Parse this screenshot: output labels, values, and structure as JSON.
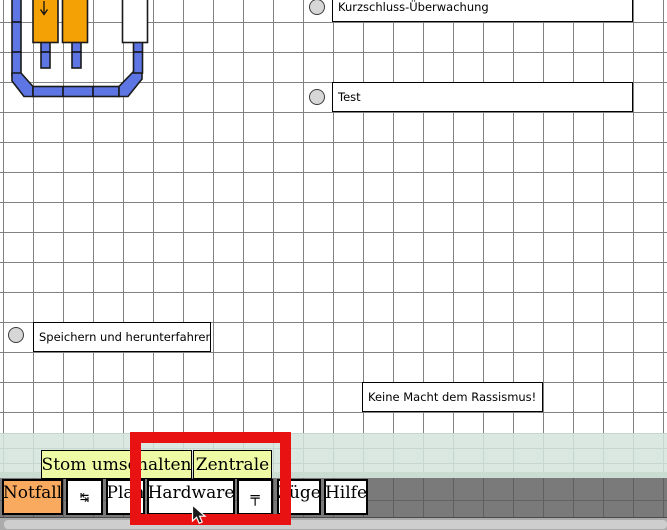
{
  "window": {
    "width": 667,
    "height": 530
  },
  "canvas": {
    "background": "#ffffff",
    "grid_color": "#828282",
    "grid_size": 30
  },
  "diagram": {
    "name": "track-layout",
    "track_color": "#5d76e3",
    "outline_color": "#1a1a1a",
    "block_occupied_color": "#f3a105",
    "block_free_color": "#ffffff",
    "blocks": [
      {
        "id": "block-1",
        "state": "occupied",
        "arrow": "↓"
      },
      {
        "id": "block-2",
        "state": "occupied"
      },
      {
        "id": "block-3",
        "state": "free"
      }
    ]
  },
  "controls": {
    "items": [
      {
        "label": "Kurzschluss-Überwachung",
        "checked": false
      },
      {
        "label": "Test",
        "checked": false
      },
      {
        "label": "Speichern und herunterfahren",
        "checked": false
      }
    ],
    "banner": "Keine Macht dem Rassismus!"
  },
  "hints": {
    "background": "#eefaa4",
    "buttons": [
      {
        "label": "Stom umschalten"
      },
      {
        "label": "Zentrale"
      }
    ]
  },
  "toolbar": {
    "background": "#7a7a7a",
    "buttons": [
      {
        "label": "Notfall",
        "background": "#f9aa5e"
      },
      {
        "label": "↹",
        "icon": "switch-direction-icon"
      },
      {
        "label": "Plan"
      },
      {
        "label": "Hardware"
      },
      {
        "label": "╤",
        "icon": "catenary-icon"
      },
      {
        "label": "Züge"
      },
      {
        "label": "Hilfe"
      }
    ]
  },
  "annotation": {
    "highlight_box_color": "#e91212"
  },
  "scrollbar": {
    "orientation": "horizontal",
    "thumb_color": "#cecece"
  }
}
